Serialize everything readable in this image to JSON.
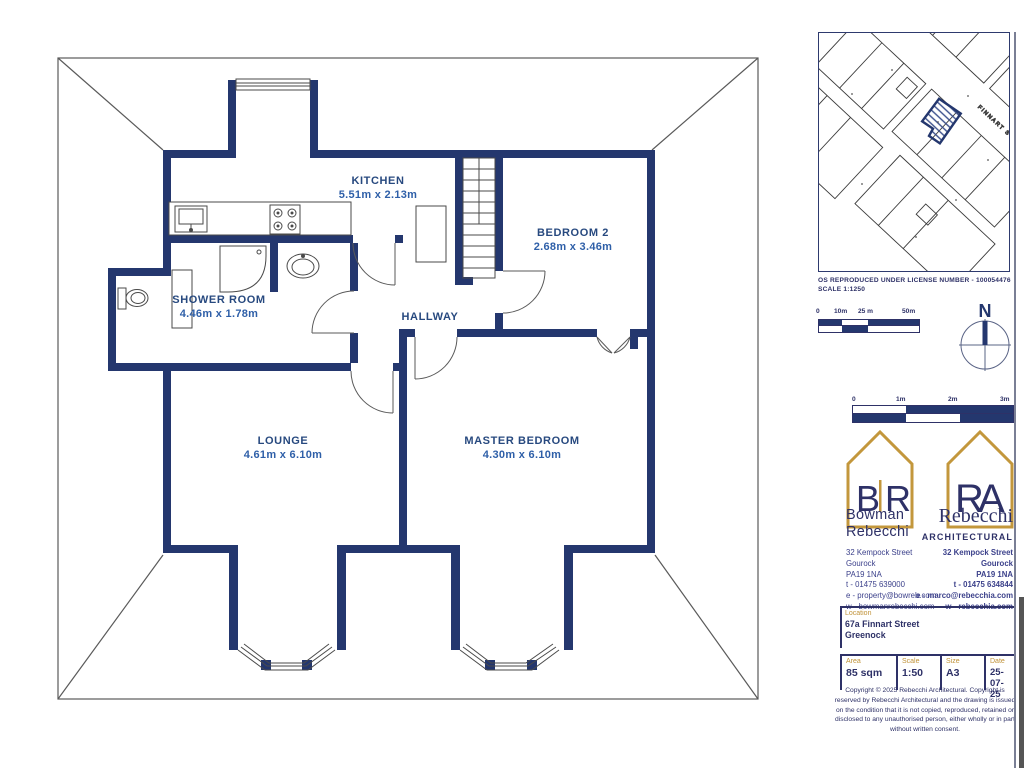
{
  "floor_plan": {
    "rooms": [
      {
        "name": "KITCHEN",
        "dims": "5.51m x 2.13m"
      },
      {
        "name": "BEDROOM 2",
        "dims": "2.68m x 3.46m"
      },
      {
        "name": "SHOWER ROOM",
        "dims": "4.46m x 1.78m"
      },
      {
        "name": "HALLWAY",
        "dims": ""
      },
      {
        "name": "LOUNGE",
        "dims": "4.61m x 6.10m"
      },
      {
        "name": "MASTER BEDROOM",
        "dims": "4.30m x 6.10m"
      }
    ]
  },
  "site_map": {
    "street_label": "FINNART ST",
    "license_line": "OS REPRODUCED UNDER LICENSE NUMBER - 100054476",
    "scale_line": "SCALE 1:1250",
    "scale_bar_labels": [
      "0",
      "10m",
      "25 m",
      "50m"
    ],
    "compass_label": "N"
  },
  "drawing_scale_bar": {
    "labels": [
      "0",
      "1m",
      "2m",
      "3m"
    ]
  },
  "branding": {
    "left": {
      "logo_letters": [
        "B",
        "R"
      ],
      "name_line1": "Bowman",
      "name_line2": "Rebecchi",
      "address1": "32 Kempock Street",
      "address2": "Gourock",
      "address3": "PA19 1NA",
      "phone": "t - 01475 639000",
      "email": "e - property@bowreb.com",
      "web": "w - bowmanrebecchi.com"
    },
    "right": {
      "logo_letters": [
        "R",
        "A"
      ],
      "name": "Rebecchi",
      "subtitle": "ARCHITECTURAL",
      "address1": "32 Kempock Street",
      "address2": "Gourock",
      "address3": "PA19 1NA",
      "phone": "t - 01475 634844",
      "email": "e - marco@rebecchia.com",
      "web": "w - rebecchia.com"
    }
  },
  "location": {
    "label": "Location",
    "line1": "67a Finnart Street",
    "line2": "Greenock"
  },
  "details": {
    "area_label": "Area",
    "area": "85 sqm",
    "scale_label": "Scale",
    "scale": "1:50",
    "size_label": "Size",
    "size": "A3",
    "date_label": "Date",
    "date": "25-07-25"
  },
  "copyright": "Copyright © 2025 Rebecchi Architectural. Copyright is reserved by Rebecchi Architectural and the drawing is issued on the condition that it is not copied, reproduced, retained or disclosed to any unauthorised person, either wholly or in part without written consent.",
  "colors": {
    "navy": "#24376e",
    "gold": "#c3973c",
    "room_label": "#27497f"
  }
}
